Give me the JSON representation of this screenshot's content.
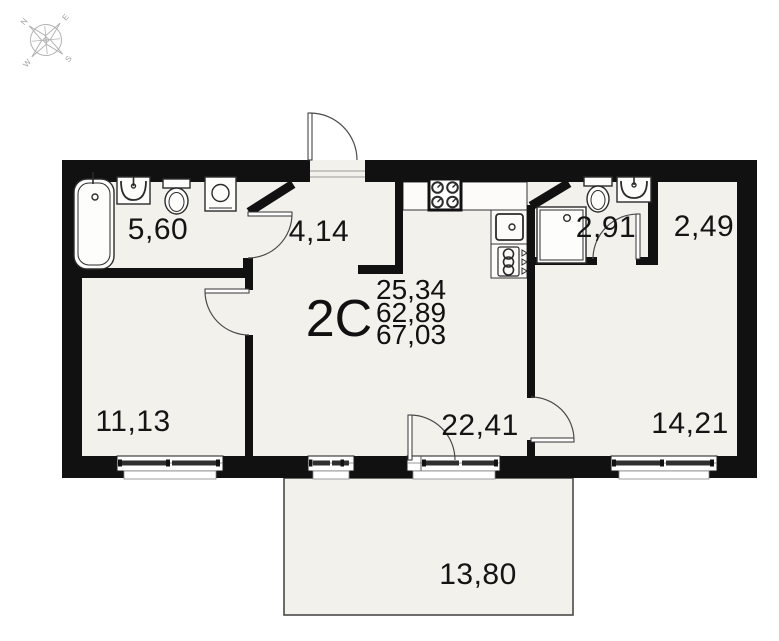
{
  "plan": {
    "apartment_label": "2С",
    "areas": {
      "living": "25,34",
      "apartment": "62,89",
      "total": "67,03"
    },
    "rooms": [
      {
        "id": "bathroom-left",
        "area": "5,60"
      },
      {
        "id": "hallway",
        "area": "4,14"
      },
      {
        "id": "bathroom-right",
        "area": "2,91"
      },
      {
        "id": "wardrobe-niche",
        "area": "2,49"
      },
      {
        "id": "bedroom-left",
        "area": "11,13"
      },
      {
        "id": "kitchen-living",
        "area": "22,41"
      },
      {
        "id": "bedroom-right",
        "area": "14,21"
      },
      {
        "id": "balcony",
        "area": "13,80"
      }
    ],
    "compass": {
      "n": "N",
      "e": "E",
      "s": "S",
      "w": "W"
    },
    "colors": {
      "wall": "#111111",
      "floor": "#f3f1ec",
      "fixture_stroke": "#2b2b2b",
      "window_dash": "#2f2f2f",
      "compass": "#b3b3b3"
    }
  }
}
